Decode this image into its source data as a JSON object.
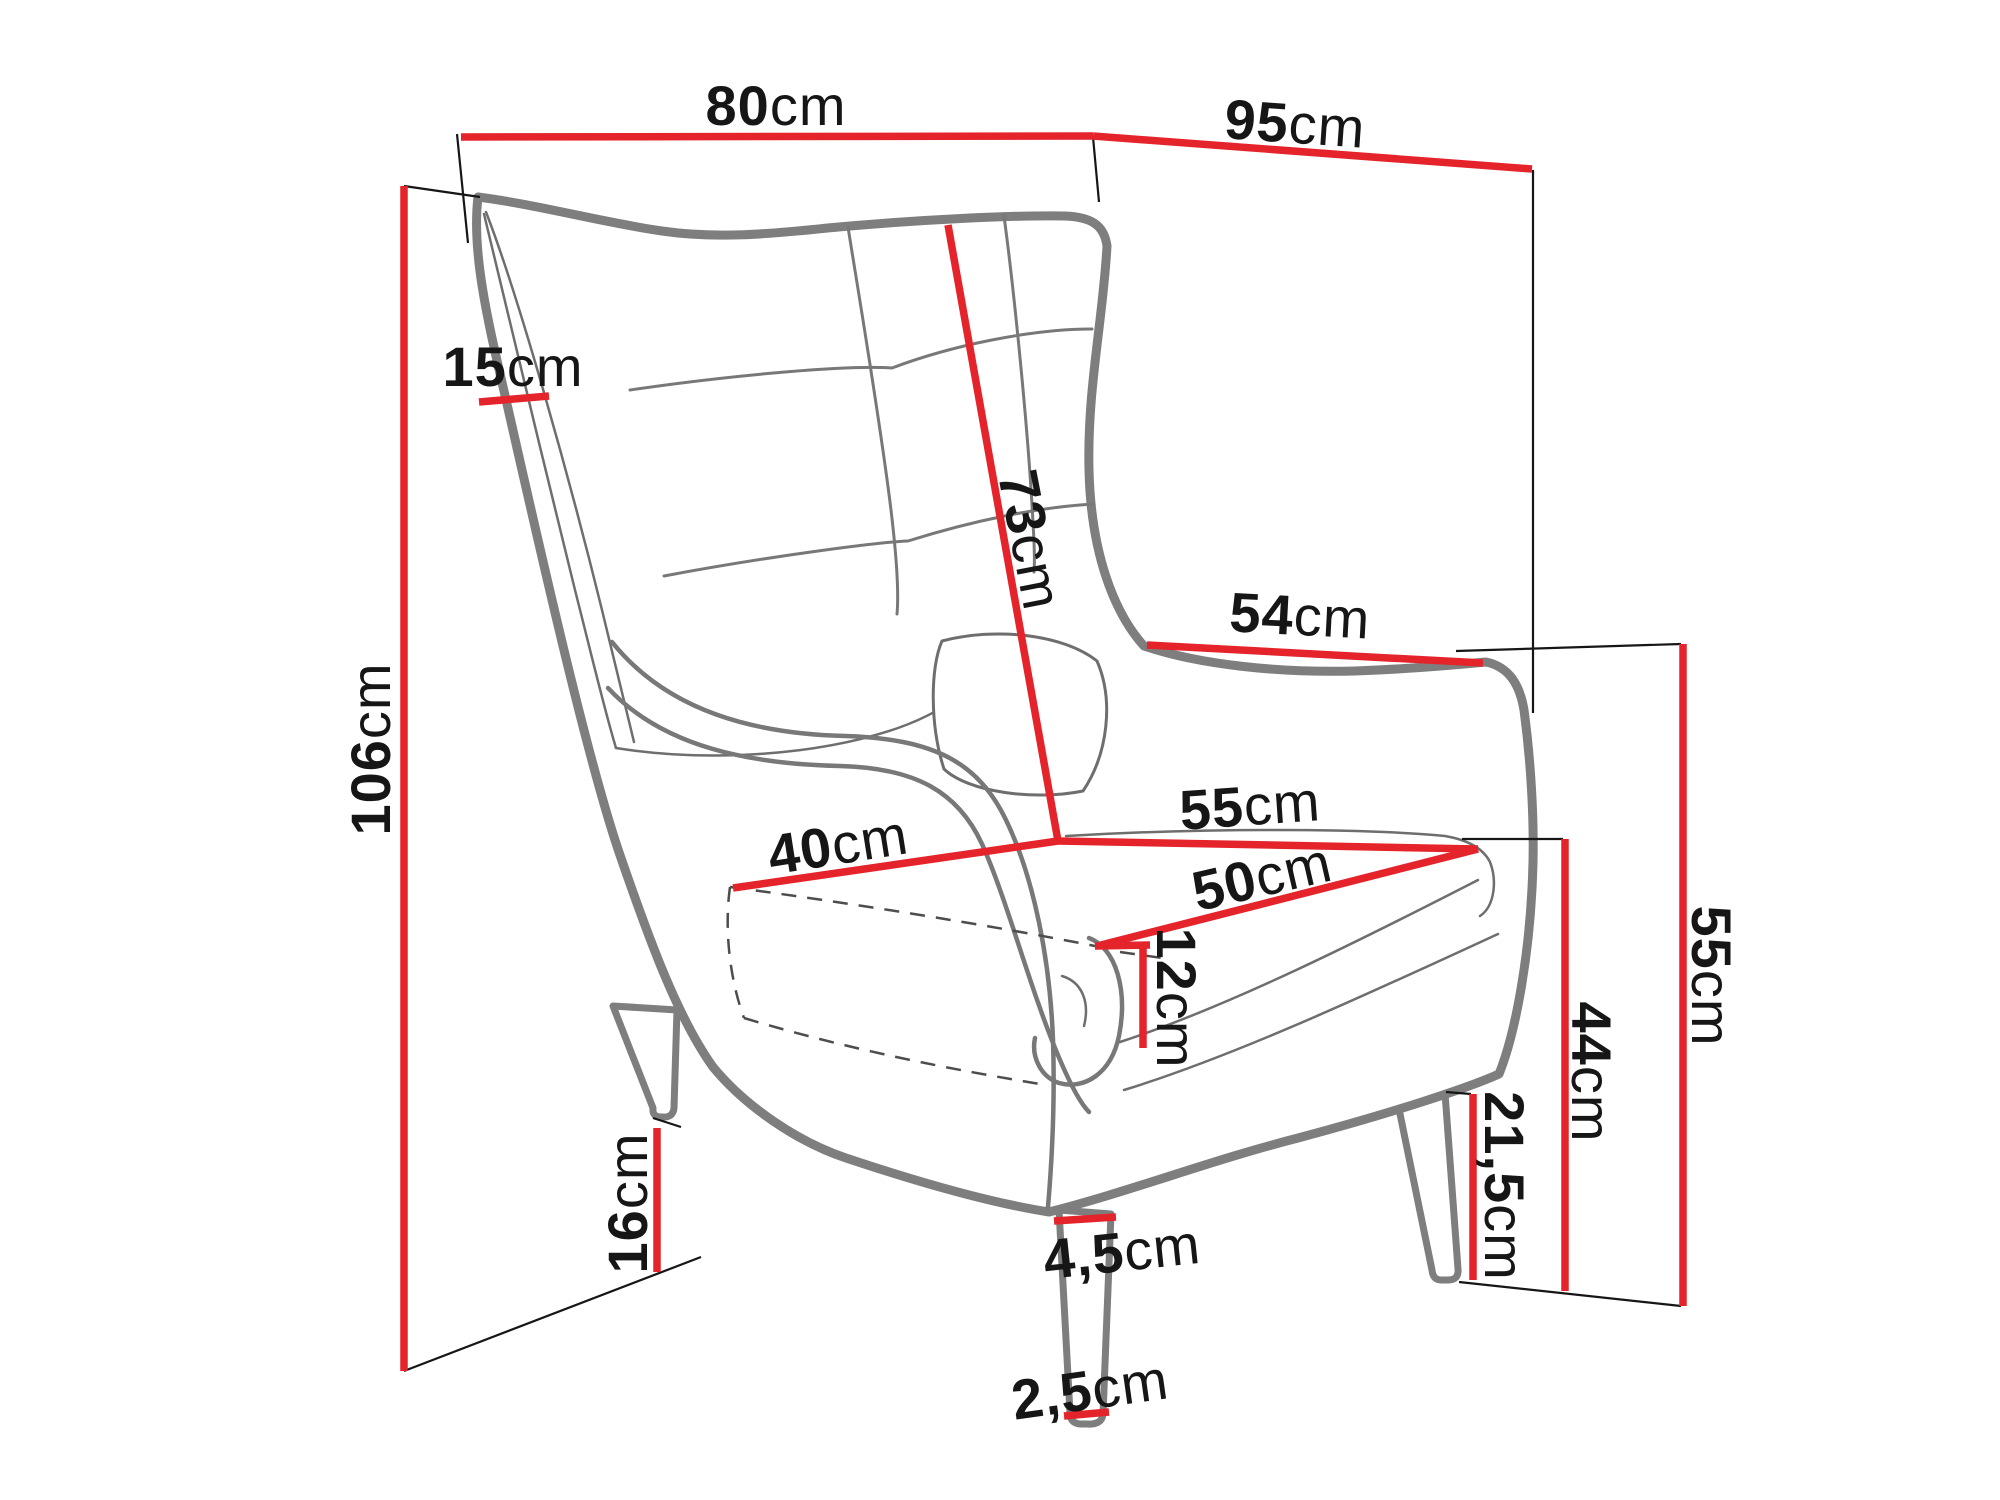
{
  "diagram": {
    "subject": "wingback armchair dimension drawing",
    "unit": "cm"
  },
  "colors": {
    "dimension_line": "#e5232b",
    "text": "#161616",
    "chair_outline": "#7e7e7e",
    "background": "#ffffff"
  },
  "dimensions": [
    {
      "id": "total-width-top",
      "num": "80",
      "unit": "cm"
    },
    {
      "id": "total-depth-top",
      "num": "95",
      "unit": "cm"
    },
    {
      "id": "total-height-left",
      "num": "106",
      "unit": "cm"
    },
    {
      "id": "wing-width",
      "num": "15",
      "unit": "cm"
    },
    {
      "id": "backrest-length",
      "num": "73",
      "unit": "cm"
    },
    {
      "id": "armrest-length",
      "num": "54",
      "unit": "cm"
    },
    {
      "id": "seat-width",
      "num": "55",
      "unit": "cm"
    },
    {
      "id": "seat-back-width",
      "num": "40",
      "unit": "cm"
    },
    {
      "id": "seat-depth",
      "num": "50",
      "unit": "cm"
    },
    {
      "id": "seat-cushion-height",
      "num": "12",
      "unit": "cm"
    },
    {
      "id": "height-to-armrest",
      "num": "55",
      "unit": "cm"
    },
    {
      "id": "seat-height",
      "num": "44",
      "unit": "cm"
    },
    {
      "id": "clearance-right",
      "num": "21,5",
      "unit": "cm"
    },
    {
      "id": "leg-height",
      "num": "16",
      "unit": "cm"
    },
    {
      "id": "leg-top-width",
      "num": "4,5",
      "unit": "cm"
    },
    {
      "id": "leg-bottom-width",
      "num": "2,5",
      "unit": "cm"
    }
  ]
}
